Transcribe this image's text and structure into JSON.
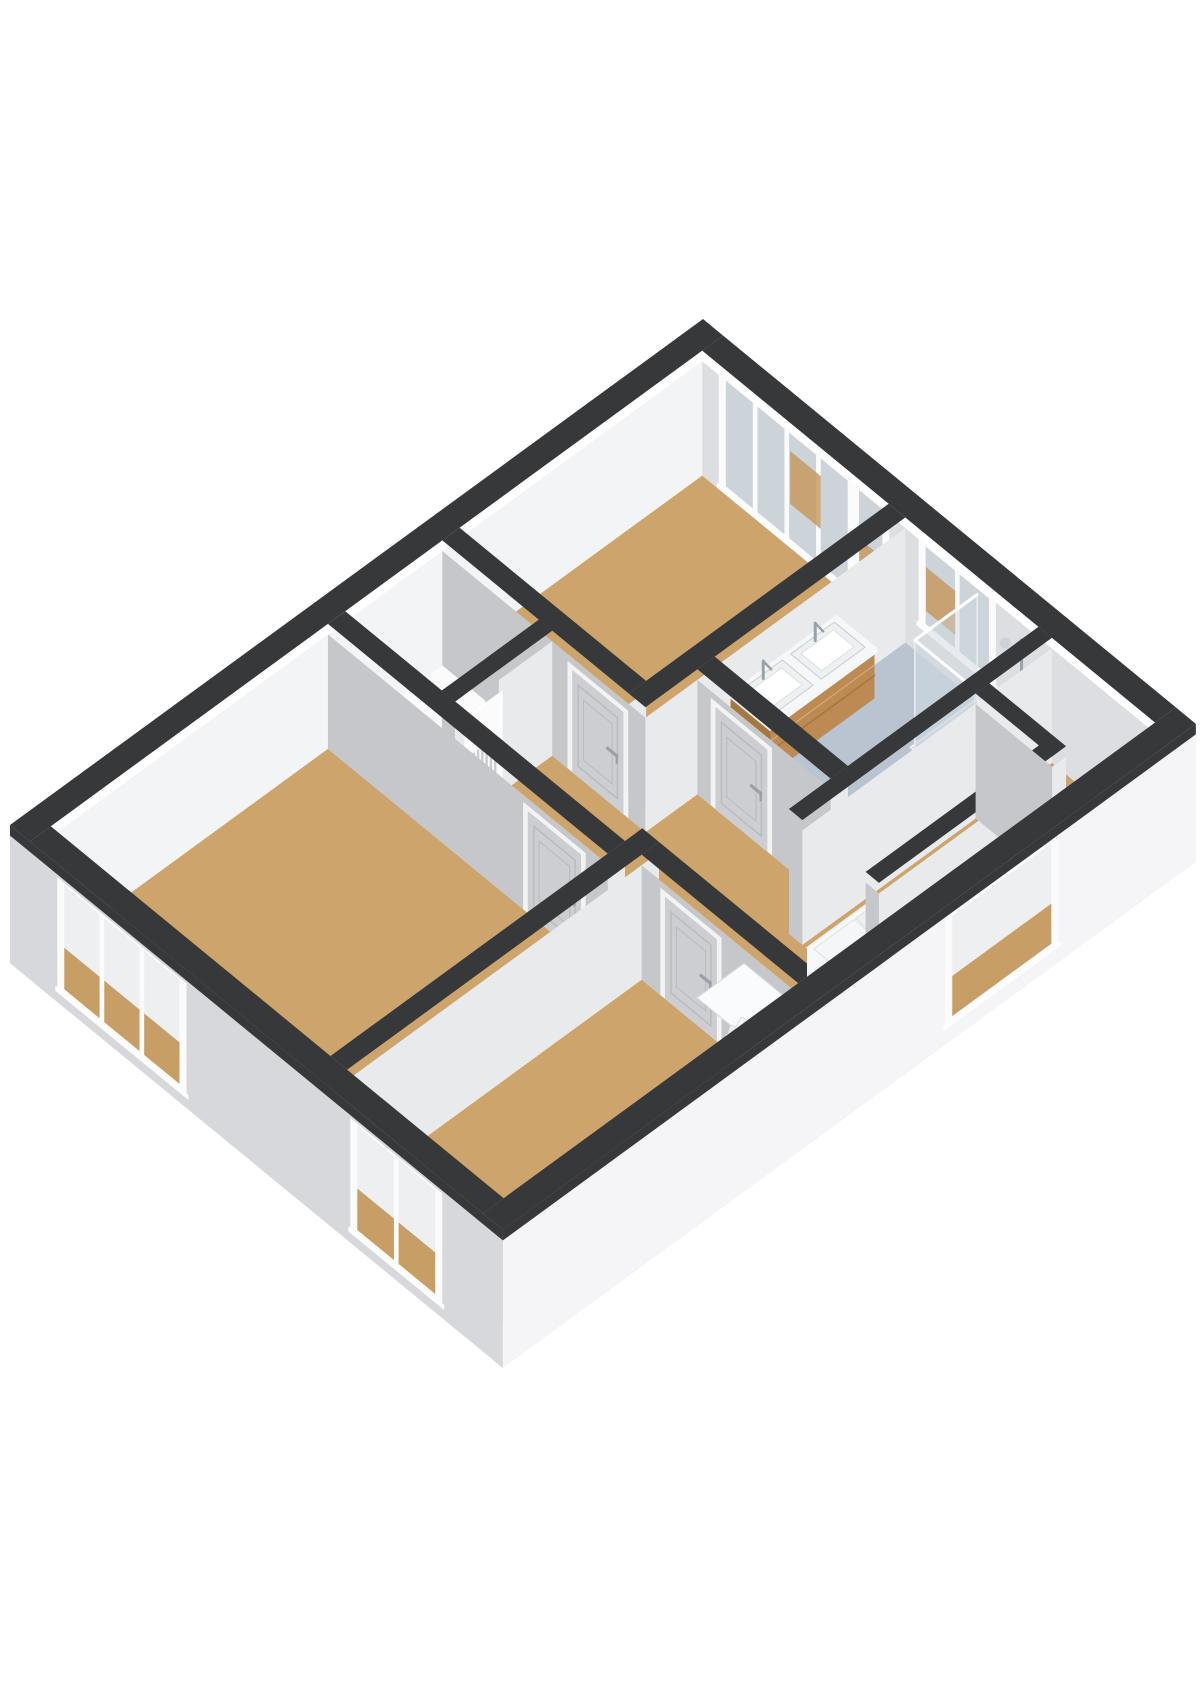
{
  "scene": {
    "width": 1200,
    "height": 1697,
    "background": "#ffffff",
    "kind": "3d-floorplan-axonometric"
  },
  "palette": {
    "cap": "#37383a",
    "floorWood": "#cda46b",
    "floorBath": "#b9c4d0",
    "floorLight": "#fbfbfc",
    "wallFaceShade": "#c6c7ca",
    "wallFaceLight": "#e9eaec",
    "intBack": "#f3f4f6",
    "intRight": "#dcdee1",
    "extLeft": "#d7d8db",
    "extFront": "#f5f5f7",
    "frame": "#fbfbfc",
    "glass": "#ccd4da",
    "throughTop": "#edeff1",
    "throughBottom": "#c79e66",
    "tanPatch": "#c59a62",
    "panel": "#cdced1",
    "panelInset": "#b9babd",
    "doorFrame": "#f3f3f4",
    "handle": "#9aa0a6",
    "wood": "#bd8a53",
    "woodSide": "#a6783f",
    "counter": "#f6f7f8",
    "basin": "#eef1f2",
    "stepA": "#fafbfc",
    "stepB": "#eef0f2",
    "stepEdge": "#d9dbde",
    "voidBase": "#eceef0",
    "voidWall": "#f7f8f9",
    "voidWallSide": "#e4e6e9",
    "tray": "#c6cfd8",
    "glassFill": "rgba(206,216,224,0.45)",
    "glassEdge": "#e8ebee",
    "chrome": "#9aa2a9",
    "radiator": "#c9cbce"
  },
  "projection": {
    "ox": 10,
    "oy": 950,
    "au": [
      69.3,
      -50.6
    ],
    "bv": [
      66.6,
      54.7
    ],
    "z": 88,
    "cut": 1.3,
    "cap": 1.42,
    "slab": -0.15
  },
  "building": {
    "U": 10.0,
    "V": 7.4,
    "extWall": 0.3
  },
  "rooms": [
    {
      "id": "floor-bedroom-left",
      "fill": "floorWood",
      "rect": [
        0.3,
        4.3,
        0.3,
        4.5
      ]
    },
    {
      "id": "floor-closet",
      "fill": "floorLight",
      "rect": [
        4.55,
        5.95,
        0.3,
        1.75
      ]
    },
    {
      "id": "floor-bedroom-top",
      "fill": "floorWood",
      "rect": [
        6.2,
        9.7,
        0.3,
        3.1
      ]
    },
    {
      "id": "floor-bathroom",
      "fill": "floorBath",
      "rect": [
        6.95,
        9.7,
        3.35,
        5.35
      ]
    },
    {
      "id": "floor-bedroom-bottom",
      "fill": "floorWood",
      "rect": [
        0.3,
        4.55,
        4.75,
        7.1
      ]
    },
    {
      "id": "floor-landing",
      "fill": "floorWood",
      "poly": [
        [
          4.55,
          1.95
        ],
        [
          5.95,
          1.95
        ],
        [
          5.95,
          3.35
        ],
        [
          6.7,
          3.35
        ],
        [
          6.7,
          5.55
        ],
        [
          9.7,
          5.55
        ],
        [
          9.7,
          7.1
        ],
        [
          4.8,
          7.1
        ],
        [
          4.8,
          4.75
        ],
        [
          4.55,
          4.75
        ]
      ]
    }
  ],
  "walls": [
    {
      "id": "wall-bedroomtop-west",
      "rect": [
        5.95,
        6.2,
        0.3,
        3.1
      ],
      "door": {
        "id": "door-bedroom-top",
        "v1": 2.25,
        "v2": 3.02
      }
    },
    {
      "id": "wall-closet-south-a",
      "rect": [
        4.55,
        4.68,
        1.75,
        1.95
      ]
    },
    {
      "id": "wall-closet-south-b",
      "rect": [
        5.18,
        5.95,
        1.75,
        1.95
      ]
    },
    {
      "id": "wall-closet-cap",
      "capOnly": true,
      "rect": [
        4.55,
        5.95,
        1.75,
        1.95
      ]
    },
    {
      "id": "wall-bedroomleft-east",
      "rect": [
        4.3,
        4.55,
        0.3,
        4.5
      ],
      "door": {
        "id": "door-bedroom-left",
        "v1": 3.3,
        "v2": 4.1
      }
    },
    {
      "id": "wall-bedroomtop-south",
      "rect": [
        5.95,
        9.7,
        3.1,
        3.35
      ]
    },
    {
      "id": "wall-bathroom-west",
      "rect": [
        6.7,
        6.95,
        3.35,
        5.35
      ],
      "door": {
        "id": "door-bathroom",
        "v1": 3.62,
        "v2": 4.4
      }
    },
    {
      "id": "wall-stairwell-north",
      "rect": [
        6.1,
        9.7,
        5.35,
        5.55
      ]
    },
    {
      "id": "wall-bedrooms-divider",
      "rect": [
        0.3,
        4.8,
        4.5,
        4.75
      ]
    },
    {
      "id": "wall-bedroombottom-east",
      "rect": [
        4.55,
        4.8,
        4.75,
        7.1
      ],
      "door": {
        "id": "door-bedroom-bottom",
        "v1": 5.1,
        "v2": 5.88
      }
    }
  ],
  "stairVoid": {
    "rect": [
      6.1,
      8.6,
      5.6,
      6.45
    ],
    "treads": 4,
    "southWall": {
      "id": "wall-stairwell-south",
      "rect": [
        6.1,
        8.7,
        6.5,
        6.7
      ]
    },
    "eastWall": {
      "id": "wall-stairwell-east",
      "rect": [
        8.6,
        8.8,
        5.55,
        6.7
      ]
    }
  },
  "closetOpening": {
    "u1": 4.72,
    "u2": 5.22,
    "h": 1.14,
    "plane": 1.95,
    "radiatorSlats": 6
  },
  "stairs": {
    "firstTread": [
      [
        4.82,
        5.3
      ],
      [
        5.5,
        5.3
      ],
      [
        5.5,
        6.55
      ],
      [
        4.82,
        6.55
      ]
    ],
    "pivot": [
      5.92,
      6.58
    ],
    "radius": 1.38,
    "angleStart": 187,
    "angleEnd": 265,
    "wedges": 6,
    "drop": 0.155
  },
  "windows": [
    {
      "id": "window-bedroom-left",
      "type": "U",
      "plane": 0,
      "outer": true,
      "a1": 0.78,
      "a2": 2.58,
      "z1": 0.06,
      "z2": 1.24,
      "panes": 3,
      "view": "through"
    },
    {
      "id": "window-bedroom-bottom",
      "type": "U",
      "plane": 0,
      "outer": true,
      "a1": 5.18,
      "a2": 6.42,
      "z1": 0.06,
      "z2": 1.24,
      "panes": 2,
      "view": "through"
    },
    {
      "id": "window-stairwell",
      "type": "V",
      "plane": 7.4,
      "outer": true,
      "a1": 6.45,
      "a2": 7.95,
      "z1": 0.12,
      "z2": 1.26,
      "panes": 1,
      "view": "through"
    },
    {
      "id": "window-bedroom-top",
      "type": "U",
      "plane": 9.7,
      "outer": false,
      "a1": 0.62,
      "a2": 2.52,
      "z1": 0.1,
      "z2": 1.3,
      "panes": 4,
      "view": "glass",
      "patches": [
        [
          1.62,
          2.08,
          0.5,
          1.1
        ]
      ]
    },
    {
      "id": "window-bedroom-top-tall",
      "type": "U",
      "plane": 9.7,
      "outer": false,
      "a1": 2.62,
      "a2": 3.04,
      "z1": 0.04,
      "z2": 1.3,
      "panes": 1,
      "view": "glass",
      "patches": [
        [
          2.66,
          3.0,
          0.15,
          0.75
        ]
      ]
    },
    {
      "id": "window-bathroom",
      "type": "U",
      "plane": 9.7,
      "outer": false,
      "a1": 3.62,
      "a2": 4.64,
      "z1": 0.4,
      "z2": 1.28,
      "panes": 2,
      "view": "glass",
      "patches": [
        [
          3.66,
          4.1,
          0.55,
          1.05
        ]
      ]
    }
  ],
  "vanity": {
    "u1": 7.15,
    "u2": 8.65,
    "vBack": 3.38,
    "vFront": 3.98,
    "zBottom": 0.36,
    "zTop": 0.88,
    "counterTop": 0.92,
    "basins": 2
  },
  "shower": {
    "tray": [
      8.75,
      9.7,
      4.42,
      5.35
    ],
    "glassU": 8.78,
    "glassV": 4.45,
    "height": 1.24,
    "column": [
      9.58,
      5.22
    ]
  },
  "capRing": [
    [
      0,
      10,
      0,
      0.3
    ],
    [
      0,
      10,
      7.1,
      7.4
    ],
    [
      0,
      0.3,
      0.3,
      7.1
    ],
    [
      9.7,
      10,
      0.3,
      7.1
    ]
  ]
}
